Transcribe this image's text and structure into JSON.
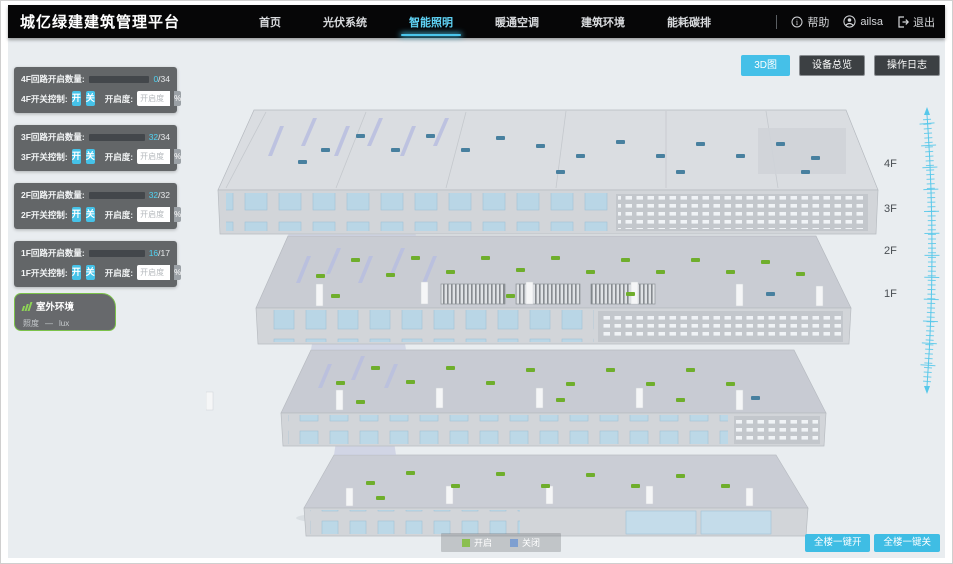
{
  "header": {
    "title": "城亿绿建建筑管理平台",
    "nav": [
      {
        "label": "首页"
      },
      {
        "label": "光伏系统"
      },
      {
        "label": "智能照明"
      },
      {
        "label": "暖通空调"
      },
      {
        "label": "建筑环境"
      },
      {
        "label": "能耗碳排"
      }
    ],
    "help": "帮助",
    "username": "ailsa",
    "logout": "退出"
  },
  "toolbar": {
    "view_3d": "3D图",
    "device_overview": "设备总览",
    "operation_log": "操作日志"
  },
  "floor_panels": [
    {
      "count_label": "4F回路开启数量:",
      "open": "0",
      "total": "/34",
      "progress": 0,
      "switch_label": "4F开关控制:",
      "on": "开",
      "off": "关",
      "dim_label": "开启度:",
      "dim_placeholder": "开启度",
      "percent": "%"
    },
    {
      "count_label": "3F回路开启数量:",
      "open": "32",
      "total": "/34",
      "progress": 94,
      "switch_label": "3F开关控制:",
      "on": "开",
      "off": "关",
      "dim_label": "开启度:",
      "dim_placeholder": "开启度",
      "percent": "%"
    },
    {
      "count_label": "2F回路开启数量:",
      "open": "32",
      "total": "/32",
      "progress": 100,
      "switch_label": "2F开关控制:",
      "on": "开",
      "off": "关",
      "dim_label": "开启度:",
      "dim_placeholder": "开启度",
      "percent": "%"
    },
    {
      "count_label": "1F回路开启数量:",
      "open": "16",
      "total": "/17",
      "progress": 94,
      "switch_label": "1F开关控制:",
      "on": "开",
      "off": "关",
      "dim_label": "开启度:",
      "dim_placeholder": "开启度",
      "percent": "%"
    }
  ],
  "outdoor": {
    "title": "室外环境",
    "illuminance_label": "照度",
    "illuminance_value": "—",
    "illuminance_unit": "lux"
  },
  "floor_scale": {
    "labels": [
      "4F",
      "3F",
      "2F",
      "1F"
    ]
  },
  "legend": {
    "on": "开启",
    "off": "关闭",
    "on_color": "#8abf4f",
    "off_color": "#7e9fd0"
  },
  "bulk_buttons": {
    "all_on": "全楼一键开",
    "all_off": "全楼一键关"
  },
  "colors": {
    "accent": "#45c0e8",
    "marker_on": "#6fae2c",
    "marker_off": "#48809f"
  }
}
